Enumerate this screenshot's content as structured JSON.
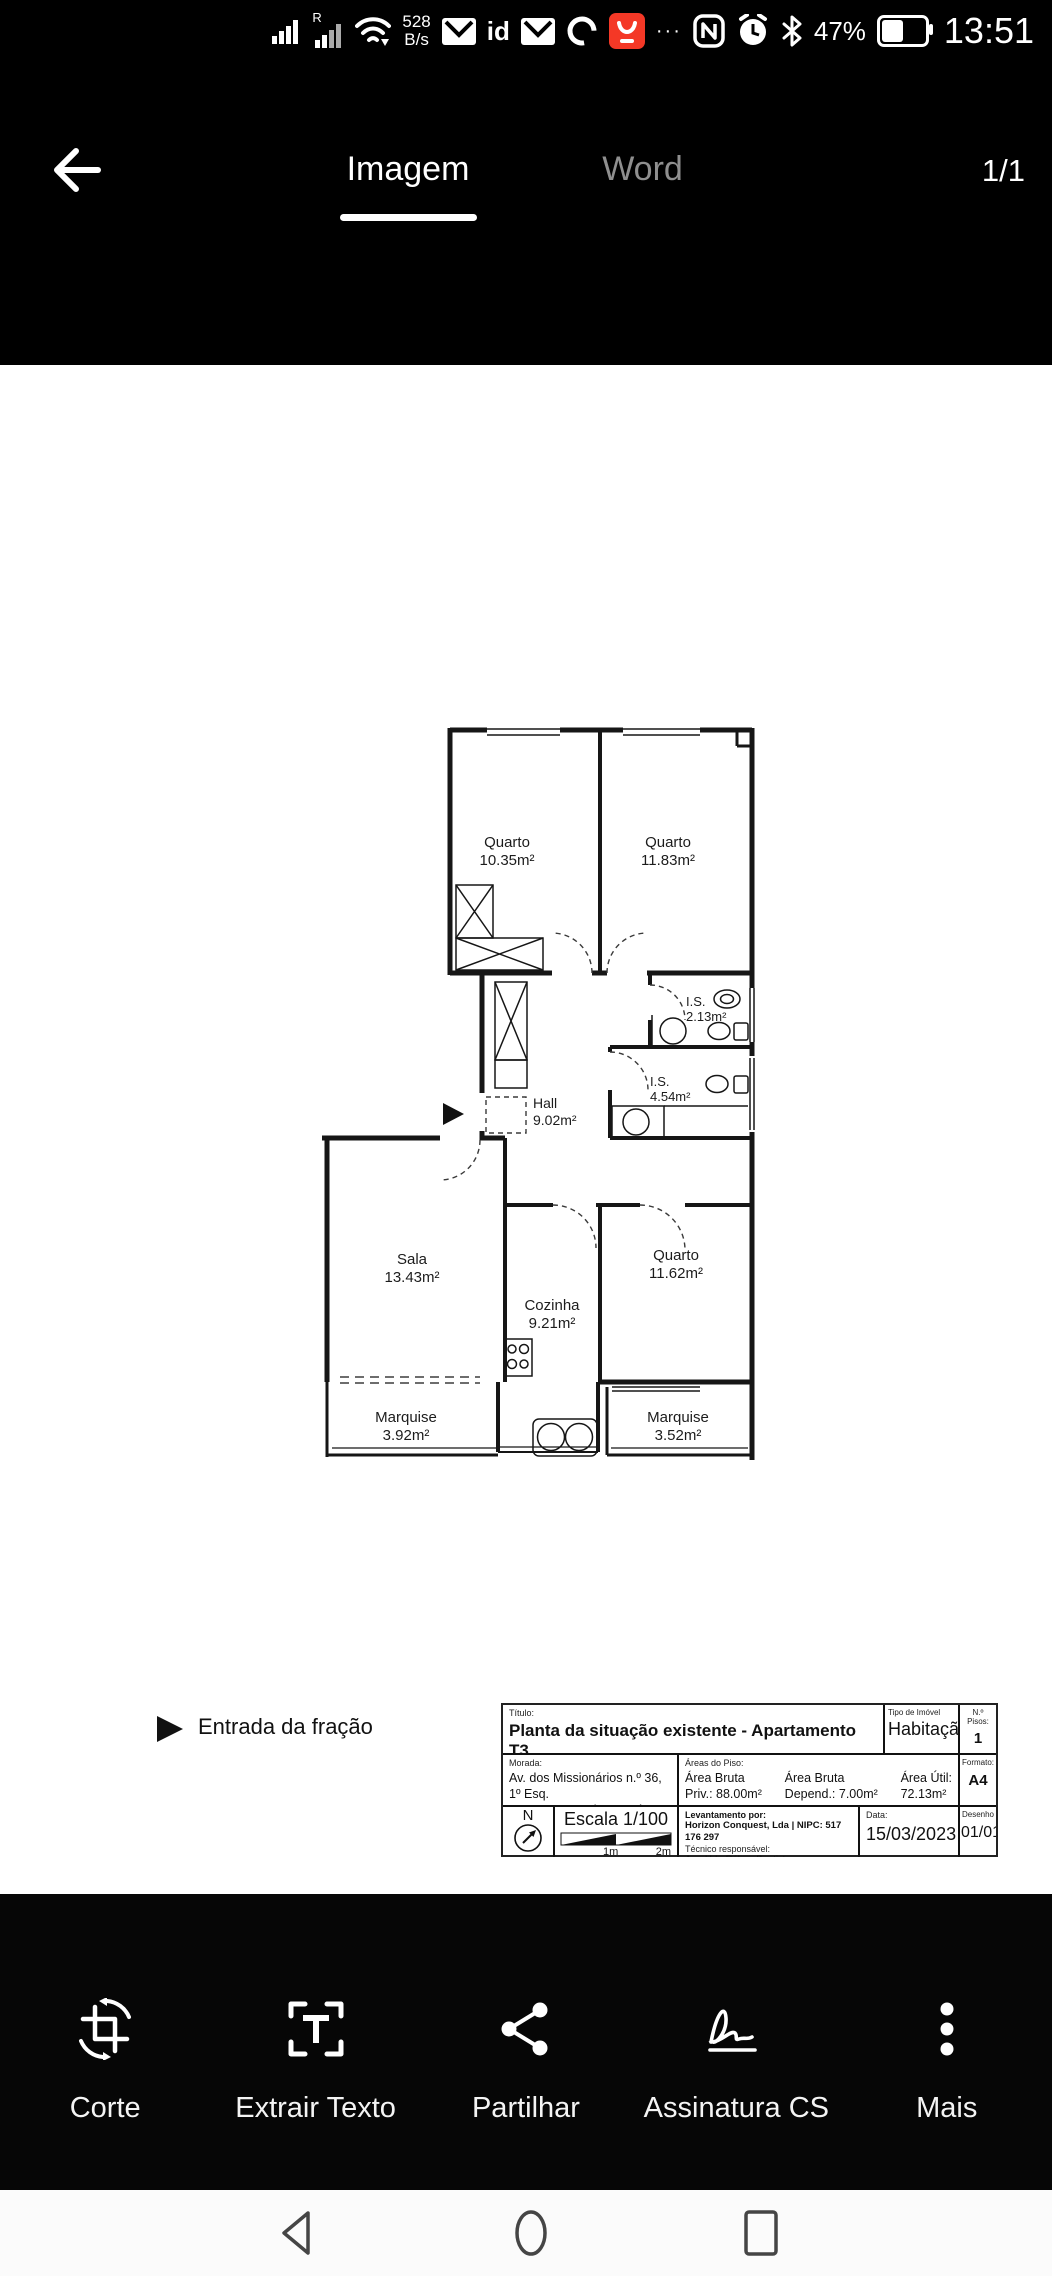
{
  "status_bar": {
    "carrier_badge": "R",
    "network_speed_value": "528",
    "network_speed_unit": "B/s",
    "id_badge": "id",
    "overflow_dots": "···",
    "battery_percent": "47%",
    "time": "13:51"
  },
  "header": {
    "tabs": [
      {
        "label": "Imagem"
      },
      {
        "label": "Word"
      }
    ],
    "page_indicator": "1/1"
  },
  "floorplan": {
    "rooms": [
      {
        "name": "Quarto",
        "area": "10.35m²"
      },
      {
        "name": "Quarto",
        "area": "11.83m²"
      },
      {
        "name": "I.S.",
        "area": "2.13m²"
      },
      {
        "name": "I.S.",
        "area": "4.54m²"
      },
      {
        "name": "Hall",
        "area": "9.02m²"
      },
      {
        "name": "Sala",
        "area": "13.43m²"
      },
      {
        "name": "Cozinha",
        "area": "9.21m²"
      },
      {
        "name": "Quarto",
        "area": "11.62m²"
      },
      {
        "name": "Marquise",
        "area": "3.92m²"
      },
      {
        "name": "Marquise",
        "area": "3.52m²"
      }
    ],
    "entrance_label": "Entrada da fração"
  },
  "title_block": {
    "titulo_label": "Título:",
    "titulo": "Planta da situação existente - Apartamento T3",
    "tipo_label": "Tipo de Imóvel",
    "tipo": "Habitação",
    "pisos_label": "N.º Pisos:",
    "pisos": "1",
    "morada_label": "Morada:",
    "morada_line1": "Av. dos Missionários n.º 36, 1º Esq.",
    "morada_line2": "2735-133 Agualva-Cacém, Sintra",
    "areas_label": "Áreas do Piso:",
    "area1_l1": "Área Bruta",
    "area1_l2": "Priv.: 88.00m²",
    "area2_l1": "Área Bruta",
    "area2_l2": "Depend.: 7.00m²",
    "area3_l1": "Área Útil:",
    "area3_l2": "72.13m²",
    "formato_label": "Formato:",
    "formato": "A4",
    "north_letter": "N",
    "escala": "Escala 1/100",
    "scale_1m": "1m",
    "scale_2m": "2m",
    "levantamento_label": "Levantamento por:",
    "levantamento": "Horizon Conquest, Lda | NIPC: 517 176 297",
    "tecnico_label": "Técnico responsável:",
    "tecnico": "Arq. Urb. Rúben Baptista",
    "data_label": "Data:",
    "data": "15/03/2023",
    "desenho_label": "Desenho",
    "desenho": "01/01"
  },
  "toolbar": {
    "items": [
      {
        "label": "Corte"
      },
      {
        "label": "Extrair Texto"
      },
      {
        "label": "Partilhar"
      },
      {
        "label": "Assinatura CS"
      },
      {
        "label": "Mais"
      }
    ]
  }
}
